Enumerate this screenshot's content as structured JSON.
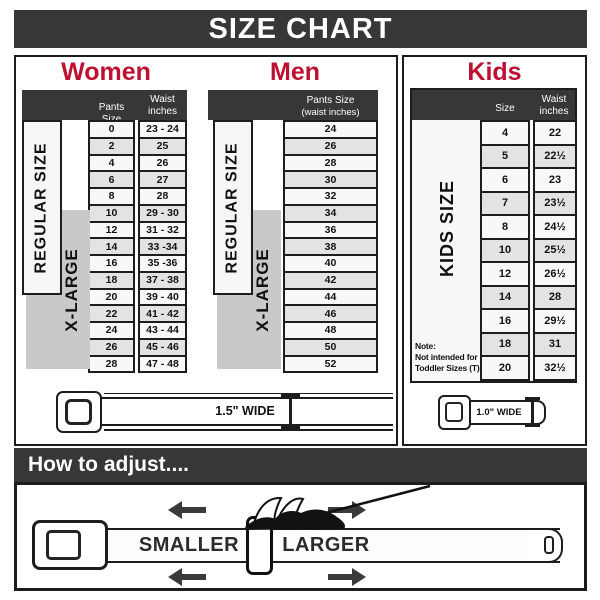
{
  "title": "SIZE CHART",
  "colors": {
    "accent": "#BE1031",
    "bar": "#373737",
    "xlarge_fill": "#c9c9c9",
    "row_alt": "#e3e3e3"
  },
  "chart_data": [
    {
      "type": "table",
      "title": "Women",
      "columns": [
        "Pants Size",
        "Waist inches"
      ],
      "rows": [
        [
          "0",
          "23 - 24"
        ],
        [
          "2",
          "25"
        ],
        [
          "4",
          "26"
        ],
        [
          "6",
          "27"
        ],
        [
          "8",
          "28"
        ],
        [
          "10",
          "29 - 30"
        ],
        [
          "12",
          "31 - 32"
        ],
        [
          "14",
          "33 -34"
        ],
        [
          "16",
          "35 -36"
        ],
        [
          "18",
          "37 - 38"
        ],
        [
          "20",
          "39 - 40"
        ],
        [
          "22",
          "41 - 42"
        ],
        [
          "24",
          "43 - 44"
        ],
        [
          "26",
          "45 - 46"
        ],
        [
          "28",
          "47 - 48"
        ]
      ]
    },
    {
      "type": "table",
      "title": "Men",
      "columns": [
        "Pants Size (waist inches)"
      ],
      "rows": [
        [
          "24"
        ],
        [
          "26"
        ],
        [
          "28"
        ],
        [
          "30"
        ],
        [
          "32"
        ],
        [
          "34"
        ],
        [
          "36"
        ],
        [
          "38"
        ],
        [
          "40"
        ],
        [
          "42"
        ],
        [
          "44"
        ],
        [
          "46"
        ],
        [
          "48"
        ],
        [
          "50"
        ],
        [
          "52"
        ]
      ]
    },
    {
      "type": "table",
      "title": "Kids",
      "columns": [
        "Size",
        "Waist inches"
      ],
      "rows": [
        [
          "4",
          "22"
        ],
        [
          "5",
          "22½"
        ],
        [
          "6",
          "23"
        ],
        [
          "7",
          "23½"
        ],
        [
          "8",
          "24½"
        ],
        [
          "10",
          "25½"
        ],
        [
          "12",
          "26½"
        ],
        [
          "14",
          "28"
        ],
        [
          "16",
          "29½"
        ],
        [
          "18",
          "31"
        ],
        [
          "20",
          "32½"
        ]
      ]
    }
  ],
  "women": {
    "heading": "Women",
    "col1_header": "Pants Size",
    "col2_header_line1": "Waist",
    "col2_header_line2": "inches",
    "regular_label": "REGULAR SIZE",
    "xlarge_label": "X-LARGE",
    "belt_width_label": "1.5\" WIDE"
  },
  "men": {
    "heading": "Men",
    "col_header_line1": "Pants Size",
    "col_header_line2": "(waist inches)",
    "regular_label": "REGULAR SIZE",
    "xlarge_label": "X-LARGE"
  },
  "kids": {
    "heading": "Kids",
    "col1_header": "Size",
    "col2_header_line1": "Waist",
    "col2_header_line2": "inches",
    "side_label": "KIDS SIZE",
    "note_line1": "Note:",
    "note_line2": "Not intended for",
    "note_line3": "Toddler Sizes (T)",
    "belt_width_label": "1.0\" WIDE"
  },
  "adjust": {
    "heading": "How to adjust....",
    "smaller_label": "SMALLER",
    "larger_label": "LARGER"
  }
}
